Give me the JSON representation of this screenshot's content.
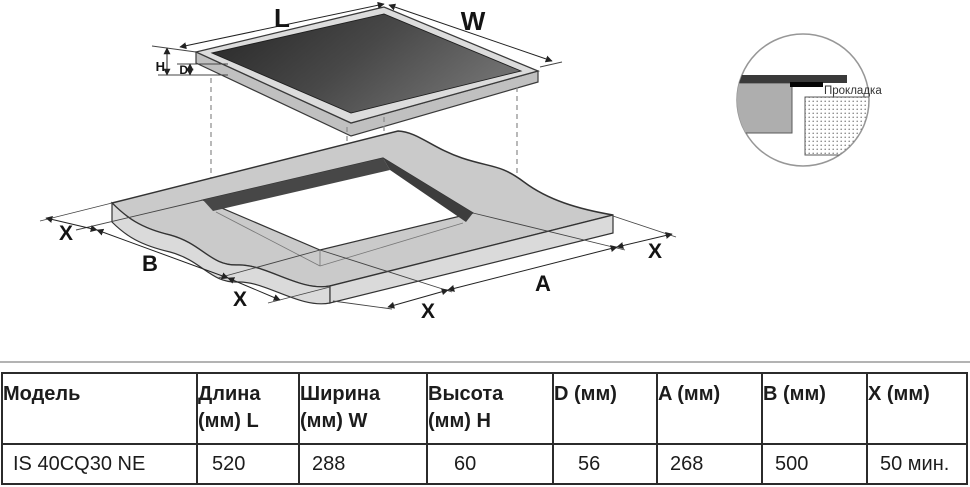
{
  "diagram": {
    "top_view": {
      "length_label": "L",
      "width_label": "W",
      "height_label": "H",
      "depth_label": "D"
    },
    "cutout_view": {
      "a_label": "A",
      "b_label": "B",
      "x_label": "X"
    },
    "detail_inset": {
      "gasket_label": "Прокладка"
    },
    "colors": {
      "glass_dark": "#2a2a2a",
      "surface_gray": "#cacaca",
      "wall_dark": "#454545"
    }
  },
  "table": {
    "columns": [
      {
        "line1": "Модель",
        "line2": ""
      },
      {
        "line1": "Длина",
        "line2": "(мм) L"
      },
      {
        "line1": "Ширина",
        "line2": "(мм) W"
      },
      {
        "line1": "Высота",
        "line2": "(мм) H"
      },
      {
        "line1": "D (мм)",
        "line2": ""
      },
      {
        "line1": "A (мм)",
        "line2": ""
      },
      {
        "line1": "B (мм)",
        "line2": ""
      },
      {
        "line1": "X (мм)",
        "line2": ""
      }
    ],
    "row": {
      "model": "IS 40CQ30 NE",
      "length": "520",
      "width": "288",
      "height": "60",
      "d": "56",
      "a": "268",
      "b": "500",
      "x": "50 мин."
    }
  }
}
